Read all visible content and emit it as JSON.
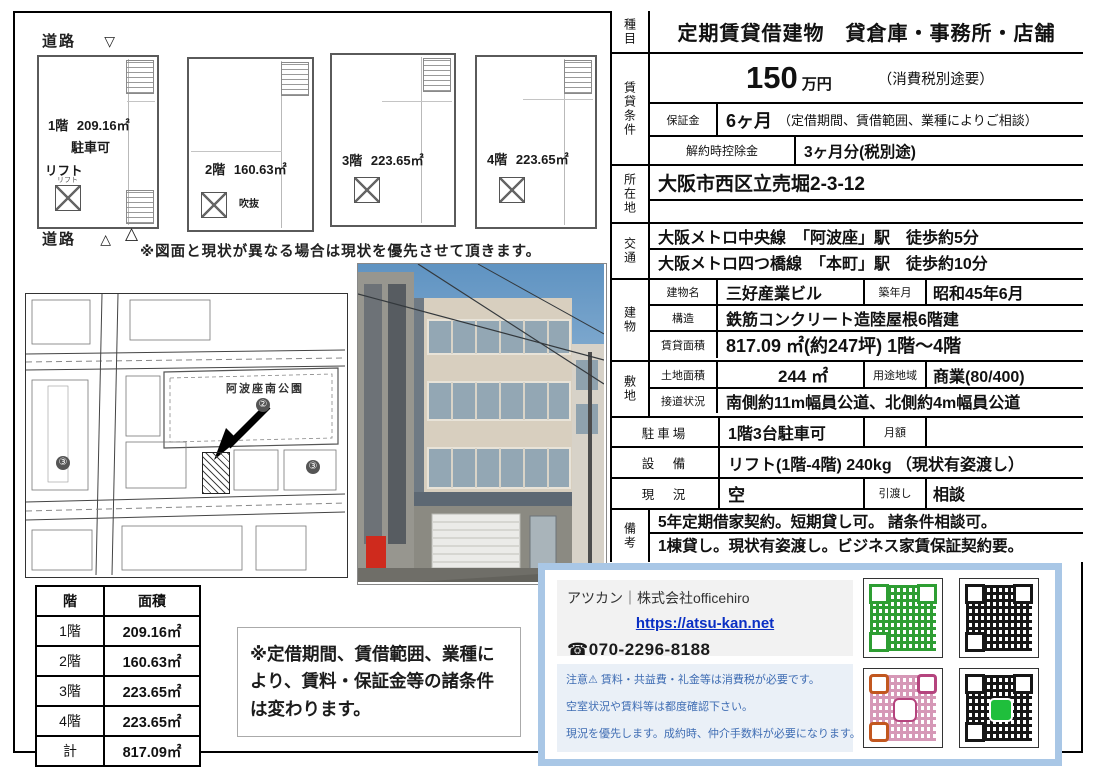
{
  "plans": {
    "road_top": "道路",
    "tri_down": "▽",
    "road_bottom": "道路",
    "tri_up": "△",
    "tri_up2": "△",
    "items": [
      {
        "floor": "1階",
        "area": "209.16㎡",
        "note": "駐車可",
        "lift": "リフト",
        "lift_small": "リフト"
      },
      {
        "floor": "2階",
        "area": "160.63㎡",
        "void": "吹抜"
      },
      {
        "floor": "3階",
        "area": "223.65㎡"
      },
      {
        "floor": "4階",
        "area": "223.65㎡"
      }
    ],
    "disclaimer": "※図面と現状が異なる場合は現状を優先させて頂きます。"
  },
  "map": {
    "park": "阿波座南公園",
    "marker2": "②",
    "marker3a": "③",
    "marker3b": "③"
  },
  "floor_table": {
    "headers": [
      "階",
      "面積"
    ],
    "rows": [
      [
        "1階",
        "209.16㎡"
      ],
      [
        "2階",
        "160.63㎡"
      ],
      [
        "3階",
        "223.65㎡"
      ],
      [
        "4階",
        "223.65㎡"
      ],
      [
        "計",
        "817.09㎡"
      ]
    ]
  },
  "note_box": "※定借期間、賃借範囲、業種により、賃料・保証金等の諸条件は変わります。",
  "spec": {
    "category_label": "種目",
    "category": "定期賃貸借建物　貸倉庫・事務所・店舗",
    "terms_label": "賃貸条件",
    "rent_value": "150",
    "rent_unit": "万円",
    "rent_tax": "（消費税別途要）",
    "deposit_label": "保証金",
    "deposit_value": "6ヶ月",
    "deposit_note": "（定借期間、賃借範囲、業種によりご相談）",
    "cancel_label": "解約時控除金",
    "cancel_value": "3ヶ月分(税別途)",
    "address_label": "所在地",
    "address": "大阪市西区立売堀2-3-12",
    "access_label": "交通",
    "access1": "大阪メトロ中央線　「阿波座」駅　徒歩約5分",
    "access2": "大阪メトロ四つ橋線　「本町」駅　徒歩約10分",
    "building_label": "建物",
    "building_name_label": "建物名",
    "building_name": "三好産業ビル",
    "built_label": "築年月",
    "built": "昭和45年6月",
    "structure_label": "構造",
    "structure": "鉄筋コンクリート造陸屋根6階建",
    "rent_area_label": "賃貸面積",
    "rent_area": "817.09 ㎡(約247坪)  1階〜4階",
    "site_label": "敷地",
    "land_area_label": "土地面積",
    "land_area": "244 ㎡",
    "zoning_label": "用途地域",
    "zoning": "商業(80/400)",
    "road_label": "接道状況",
    "road": "南側約11m幅員公道、北側約4m幅員公道",
    "parking_label": "駐車場",
    "parking": "1階3台駐車可",
    "monthly_label": "月額",
    "equipment_label": "設　備",
    "equipment": "リフト(1階-4階)  240kg （現状有姿渡し）",
    "status_label": "現　況",
    "status": "空",
    "handover_label": "引渡し",
    "handover": "相談",
    "remarks_label": "備考",
    "remarks1": "5年定期借家契約。短期貸し可。 諸条件相談可。",
    "remarks2": "1棟貸し。現状有姿渡し。ビジネス家賃保証契約要。"
  },
  "contact": {
    "company": "アツカン｜株式会社officehiro",
    "url": "https://atsu-kan.net",
    "phone_icon_glyph": "☎",
    "phone": "070-2296-8188",
    "note1": "注意⚠ 賃料・共益費・礼金等は消費税が必要です。",
    "note2": "空室状況や賃料等は都度確認下さい。",
    "note3": "現況を優先します。成約時、仲介手数料が必要になります。",
    "qr_green": "#2e9e33",
    "qr_black": "#161616",
    "qr_instagram": "#b5447e",
    "qr_line": "#161616"
  }
}
